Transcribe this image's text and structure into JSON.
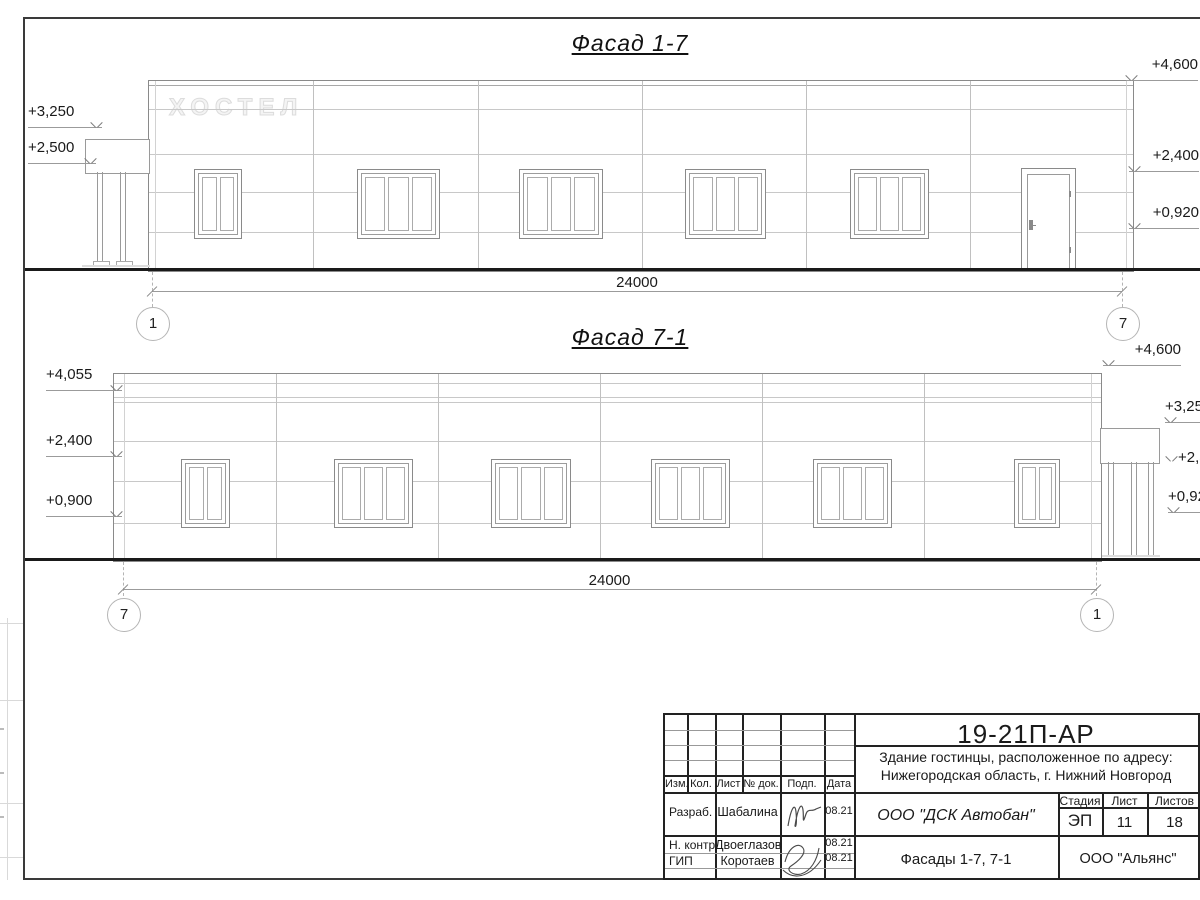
{
  "titles": {
    "facade_1_7": "Фасад 1-7",
    "facade_7_1": "Фасад 7-1"
  },
  "building_sign": "ХОСТЕЛ",
  "facade17": {
    "left_marks": [
      "+3,250",
      "+2,500"
    ],
    "right_marks": [
      "+4,600",
      "+2,400",
      "+0,920"
    ],
    "dimension": "24000",
    "grid_left": "1",
    "grid_right": "7"
  },
  "facade71": {
    "left_marks": [
      "+4,055",
      "+2,400",
      "+0,900"
    ],
    "right_marks": [
      "+4,600",
      "+3,250",
      "+2,500",
      "+0,920"
    ],
    "dimension": "24000",
    "grid_left": "7",
    "grid_right": "1"
  },
  "title_block": {
    "doc_code": "19-21П-АР",
    "description_line1": "Здание гостинцы, расположенное по адресу:",
    "description_line2": "Нижегородская область, г. Нижний Новгород",
    "columns": {
      "izm": "Изм.",
      "kol": "Кол.",
      "list": "Лист",
      "doc": "№ док.",
      "podp": "Подп.",
      "data": "Дата"
    },
    "rows": [
      {
        "role": "Разраб.",
        "name": "Шабалина",
        "date": "08.21"
      },
      {
        "role": "Н. контр.",
        "name": "Двоеглазов",
        "date": "08.21"
      },
      {
        "role": "ГИП",
        "name": "Коротаев",
        "date": "08.21"
      }
    ],
    "contractor": "ООО \"ДСК Автобан\"",
    "stage_label": "Стадия",
    "sheet_label": "Лист",
    "sheets_label": "Листов",
    "stage": "ЭП",
    "sheet": "11",
    "sheets": "18",
    "sheet_title": "Фасады 1-7, 7-1",
    "client": "ООО \"Альянс\""
  }
}
